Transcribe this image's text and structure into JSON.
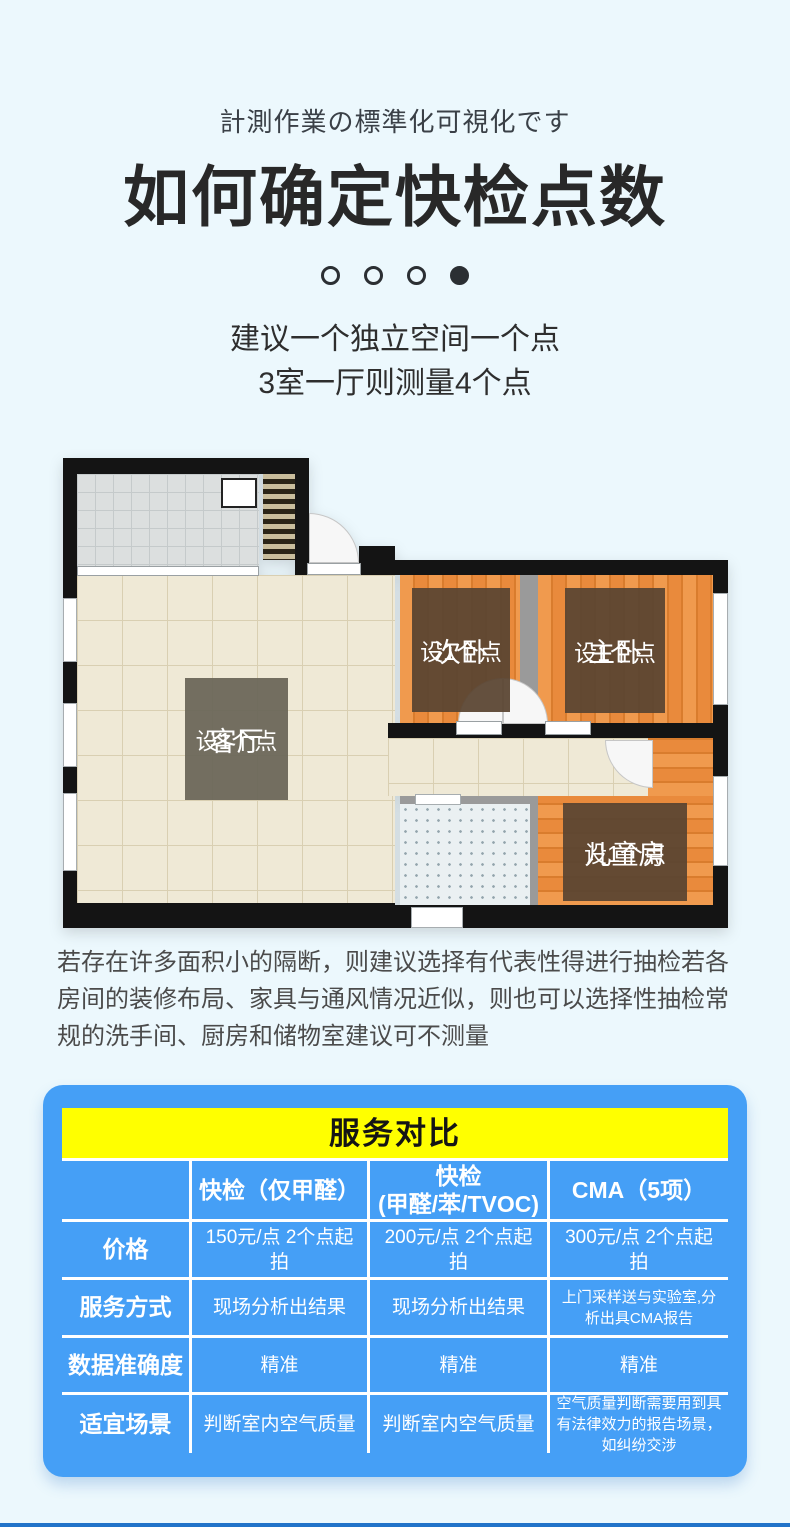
{
  "header": {
    "subtitle_jp": "計測作業の標準化可視化です",
    "title": "如何确定快检点数",
    "advice_line1": "建议一个独立空间一个点",
    "advice_line2": "3室一厅则测量4个点"
  },
  "carousel": {
    "dot_count": 4,
    "active_dot": 4
  },
  "floorplan": {
    "rooms": [
      {
        "name": "客厅",
        "note": "设1个点"
      },
      {
        "name": "次卧",
        "note": "设1个点"
      },
      {
        "name": "主卧",
        "note": "设1个点"
      },
      {
        "name": "儿童房",
        "note": "设1个点"
      }
    ]
  },
  "note": {
    "text": "若存在许多面积小的隔断，则建议选择有代表性得进行抽检若各房间的装修布局、家具与通风情况近似，则也可以选择性抽检常规的洗手间、厨房和储物室建议可不测量"
  },
  "comparison": {
    "title": "服务对比",
    "columns": [
      {
        "line1": "快检（仅甲醛）",
        "line2": ""
      },
      {
        "line1": "快检",
        "line2": "(甲醛/苯/TVOC)"
      },
      {
        "line1": "CMA（5项）",
        "line2": ""
      }
    ],
    "rows": [
      {
        "label": "价格",
        "values": [
          "150元/点 2个点起拍",
          "200元/点 2个点起拍",
          "300元/点 2个点起拍"
        ]
      },
      {
        "label": "服务方式",
        "values": [
          "现场分析出结果",
          "现场分析出结果",
          "上门采样送与实验室,分析出具CMA报告"
        ]
      },
      {
        "label": "数据准确度",
        "values": [
          "精准",
          "精准",
          "精准"
        ]
      },
      {
        "label": "适宜场景",
        "values": [
          "判断室内空气质量",
          "判断室内空气质量",
          "空气质量判断需要用到具有法律效力的报告场景，如纠纷交涉"
        ]
      }
    ]
  },
  "colors": {
    "page_bg": "#ecf8fd",
    "card_blue": "#459ff6",
    "header_yellow": "#ffff00",
    "wall_black": "#141414",
    "wood_orange": "#ec8c3f",
    "floor_beige": "#efe9d6",
    "bedroom_label_brown": "#5a4532",
    "living_label_olive": "#6b675a",
    "divider_blue": "#2273c9"
  }
}
